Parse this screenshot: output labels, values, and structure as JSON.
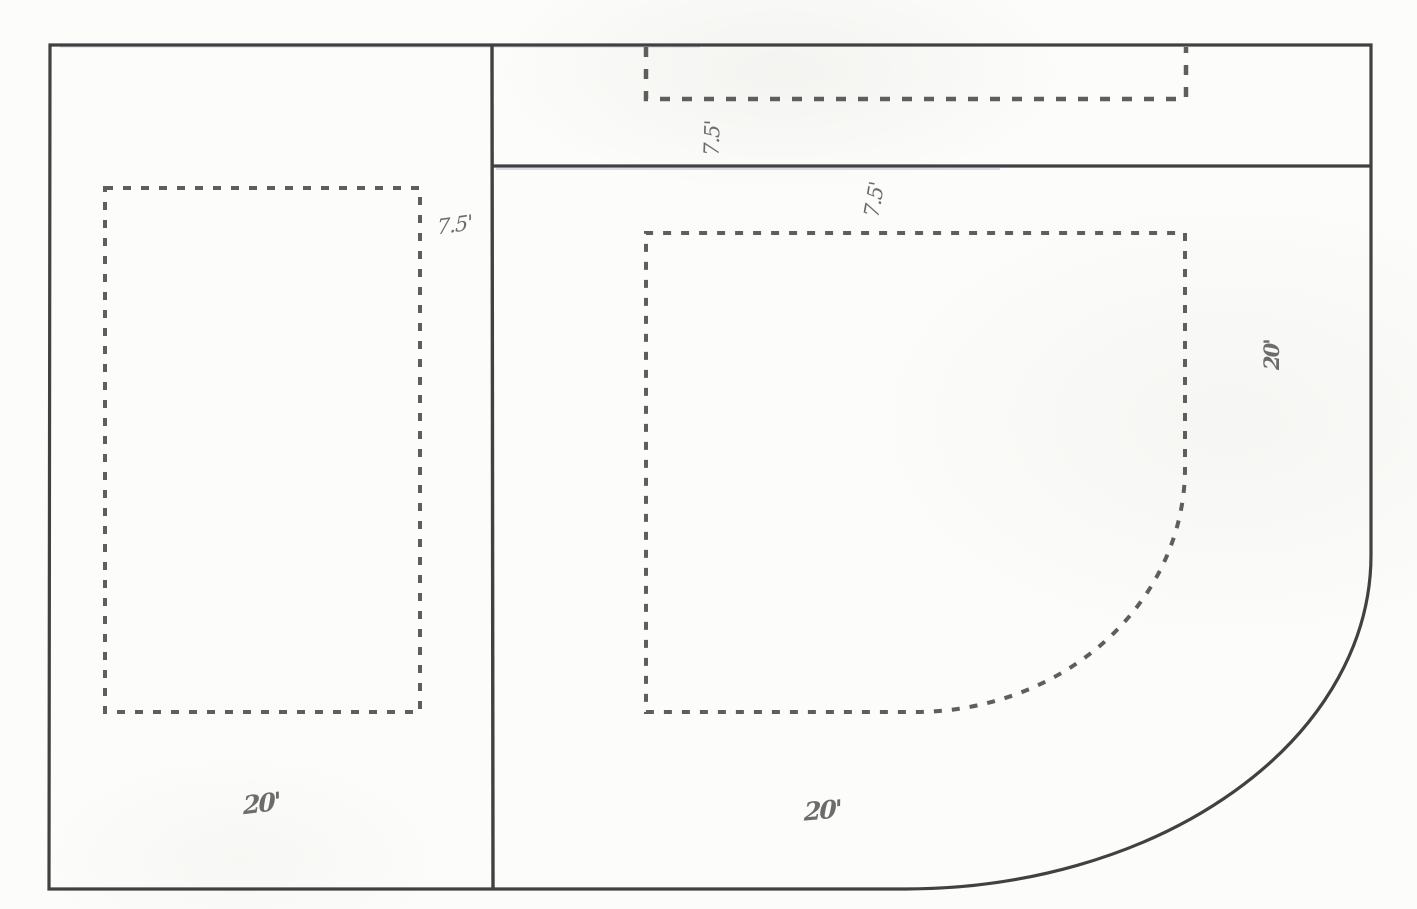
{
  "diagram": {
    "title": "corner-lot-setback-site-plan",
    "colors": {
      "background": "#fcfcfa",
      "boundary_line": "#414141",
      "dashed_setback_line": "#5e5e5e",
      "dimension_text": "#6c6c6c",
      "scan_tint": "#7d87bd"
    },
    "dimensions": {
      "left_lot_side_setback": "7.5'",
      "corner_strip_setback": "7.5'",
      "right_lot_front_setback": "7.5'",
      "left_lot_rear_dimension": "20'",
      "right_lot_rear_dimension": "20'",
      "right_lot_street_side_setback": "20'"
    }
  }
}
